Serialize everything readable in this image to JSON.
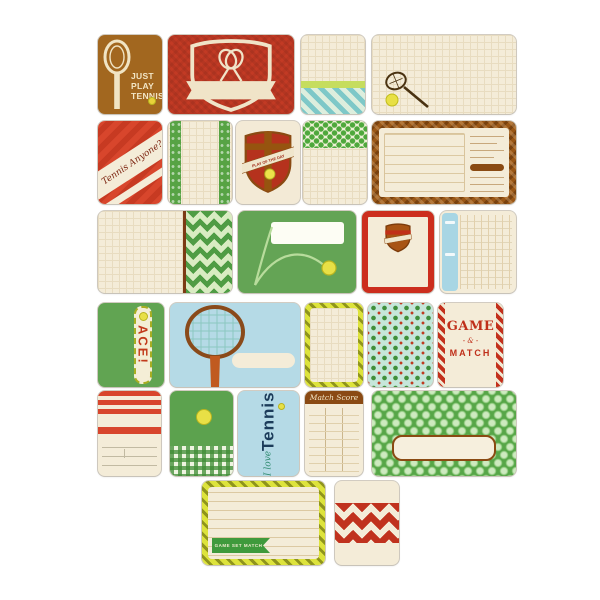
{
  "product": {
    "theme": "tennis",
    "description": "Sheet of tennis-themed journaling and filler cards arranged in six rows"
  },
  "palette": {
    "red": "#c23a24",
    "brown": "#a2671f",
    "dark_brown": "#8a4a12",
    "green": "#5ca24c",
    "light_blue": "#b5dae6",
    "cream": "#f4ecd8",
    "yellow_green": "#dde33c",
    "navy": "#1c3c5a",
    "ball_yellow": "#e8e046"
  },
  "cards": {
    "just_play_tennis": {
      "lines": [
        "JUST",
        "PLAY",
        "TENNIS"
      ]
    },
    "tennis_anyone": {
      "text": "Tennis Anyone?"
    },
    "play_of_the_day": {
      "banner_text": "PLAY OF THE DAY"
    },
    "ace": {
      "text": "ACE!"
    },
    "game_and_match": {
      "word1": "GAME",
      "ampersand": "- & -",
      "word2": "MATCH"
    },
    "i_love_tennis": {
      "script": "I love",
      "word": "Tennis"
    },
    "match_score": {
      "header": "Match Score"
    },
    "game_set_match_flag": {
      "text": "GAME SET MATCH"
    }
  },
  "icons": [
    "tennis-racket-icon",
    "crossed-rackets-shield-icon",
    "shield-badge-icon",
    "tennis-ball-icon",
    "court-bounce-icon"
  ]
}
